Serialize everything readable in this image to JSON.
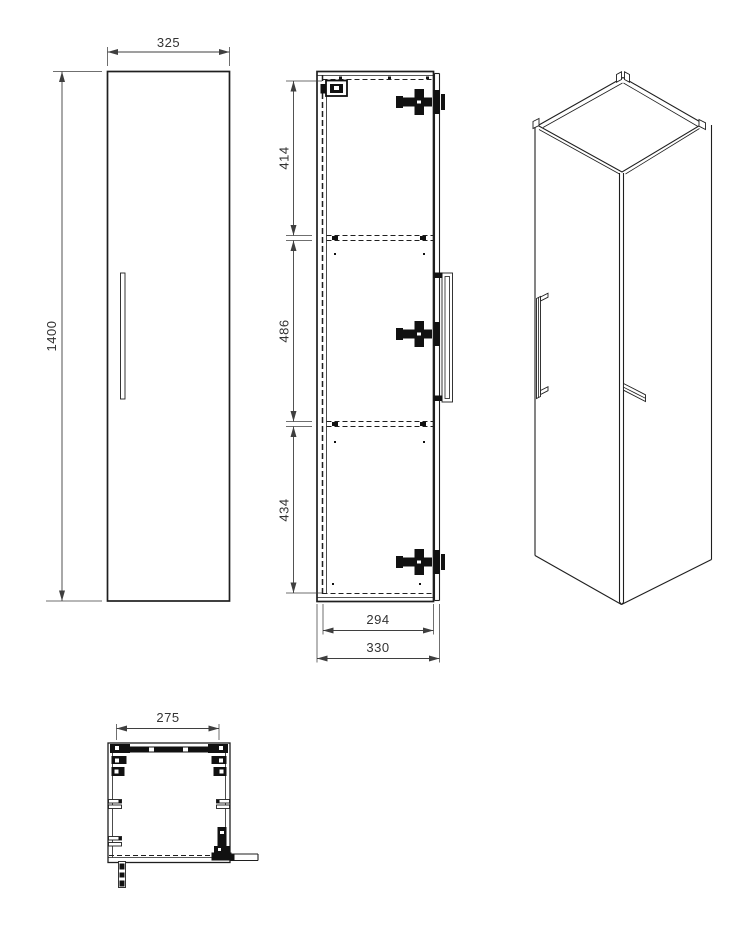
{
  "colors": {
    "line": "#1f1f1f",
    "text": "#333333",
    "dim": "#3f3f3f",
    "background": "#ffffff",
    "hardware": "#111111"
  },
  "views": {
    "front": {
      "width_mm": "325",
      "height_mm": "1400"
    },
    "section": {
      "upper_bay_mm": "414",
      "middle_bay_mm": "486",
      "lower_bay_mm": "434",
      "door_inner_depth_mm": "294",
      "outer_depth_mm": "330"
    },
    "plan": {
      "inner_width_mm": "275"
    }
  }
}
